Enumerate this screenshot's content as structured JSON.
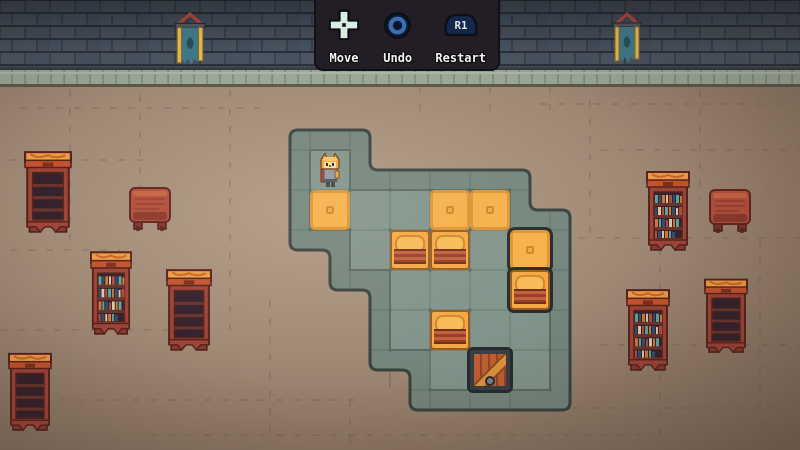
{
  "hud": {
    "controls": [
      {
        "id": "move",
        "label": "Move",
        "icon": "dpad-icon"
      },
      {
        "id": "undo",
        "label": "Undo",
        "icon": "circle-button-icon"
      },
      {
        "id": "restart",
        "label": "Restart",
        "icon": "r1-button-icon",
        "button_text": "R1"
      }
    ]
  },
  "level": {
    "tile_size": 40,
    "origin_x": 310,
    "origin_y": 150,
    "legend": {
      "X": "platform tile",
      ".": "floor"
    },
    "grid_rows": [
      "X.....",
      "XXXXX.",
      ".XXXXX",
      "..XXXX",
      "..XXXX",
      "...XXX"
    ],
    "objects": [
      {
        "type": "player",
        "col": 0,
        "row": 0
      },
      {
        "type": "goal",
        "col": 0,
        "row": 1
      },
      {
        "type": "goal",
        "col": 3,
        "row": 1
      },
      {
        "type": "goal",
        "col": 4,
        "row": 1
      },
      {
        "type": "goal",
        "col": 5,
        "row": 2,
        "dark": true
      },
      {
        "type": "bench",
        "col": 2,
        "row": 2
      },
      {
        "type": "bench",
        "col": 3,
        "row": 2
      },
      {
        "type": "bench",
        "col": 5,
        "row": 3,
        "dark": true
      },
      {
        "type": "bench",
        "col": 3,
        "row": 4
      },
      {
        "type": "crate",
        "col": 4,
        "row": 5,
        "dark": true
      }
    ]
  },
  "scene": {
    "decor": [
      {
        "type": "banner",
        "x": 174,
        "y": 12,
        "w": 32,
        "h": 56
      },
      {
        "type": "banner",
        "x": 612,
        "y": 12,
        "w": 30,
        "h": 54
      },
      {
        "type": "bookshelf",
        "variant": "empty",
        "x": 24,
        "y": 146,
        "w": 48,
        "h": 88
      },
      {
        "type": "table",
        "x": 128,
        "y": 186,
        "w": 44,
        "h": 46
      },
      {
        "type": "bookshelf",
        "variant": "books",
        "x": 90,
        "y": 246,
        "w": 42,
        "h": 90
      },
      {
        "type": "bookshelf",
        "variant": "empty",
        "x": 166,
        "y": 264,
        "w": 46,
        "h": 88
      },
      {
        "type": "bookshelf",
        "variant": "empty",
        "x": 8,
        "y": 348,
        "w": 44,
        "h": 84
      },
      {
        "type": "bookshelf",
        "variant": "books",
        "x": 646,
        "y": 166,
        "w": 44,
        "h": 86
      },
      {
        "type": "table",
        "x": 708,
        "y": 188,
        "w": 44,
        "h": 46
      },
      {
        "type": "bookshelf",
        "variant": "books",
        "x": 626,
        "y": 284,
        "w": 44,
        "h": 88
      },
      {
        "type": "bookshelf",
        "variant": "empty",
        "x": 704,
        "y": 274,
        "w": 44,
        "h": 80
      }
    ],
    "colors": {
      "wall_brick": "#4a5561",
      "wall_mortar": "#2b313b",
      "wall_trim": "#9aa795",
      "floor": "#9d8672",
      "platform_border": "#74867d",
      "platform_tile": "#81948b",
      "goal_orange": "#f6b149",
      "bench_orange": "#f3a943",
      "bench_red": "#93402a",
      "crate_wood": "#c05f33",
      "furniture_red": "#a04438",
      "banner_teal": "#41798a",
      "panel_bg": "#231d25",
      "hud_text": "#f2f4ee",
      "button_blue": "#3e6db3",
      "dpad_mint": "#d9ece1"
    }
  }
}
